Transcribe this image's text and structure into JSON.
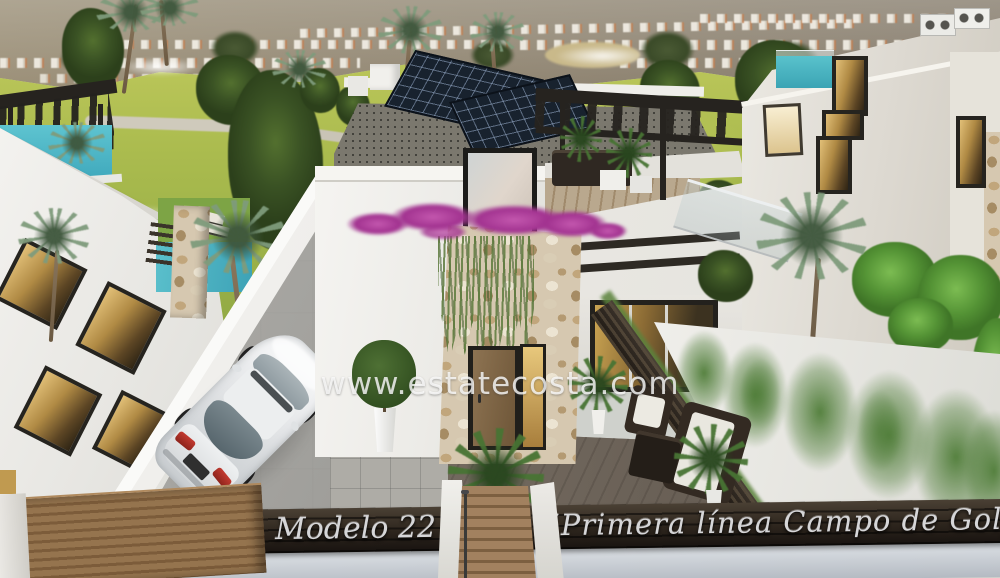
{
  "image": {
    "kind": "architectural 3d render",
    "subject": "modern villa beside golf course"
  },
  "watermark": "www.estatecosta.com",
  "caption_bar": {
    "model": "Modelo 22",
    "slogan": "“Primera línea Campo de Golf”"
  },
  "colors": {
    "sky": "#d3d5d0",
    "hill": "#8a7b5f",
    "grass": "#a3b74a",
    "tree": "#3e5629",
    "palm": "#7f9b7c",
    "villa-white": "#f1f0ec",
    "villa-shade": "#dddbd4",
    "stone": "#d6c8b0",
    "bougainvillea": "#b2439c",
    "vine": "#5c7a3c",
    "door-wood": "#81674a",
    "amber": "#c9a152",
    "solar": "#18222e",
    "pergola": "#26231f",
    "pool": "#4db4c2",
    "tile": "#9d9c98",
    "deck": "#6e655a",
    "car-body": "#e3e5e7",
    "car-glass": "#5f6d74",
    "taillight": "#ae2f27",
    "ivy": "#4e7c37",
    "fence": "#2e2822",
    "band": "#2b231b",
    "band-text": "#d6d6d8",
    "bottom-wall": "#c6ccd3",
    "gate": "#866744",
    "step-wood": "#8a6f50"
  }
}
